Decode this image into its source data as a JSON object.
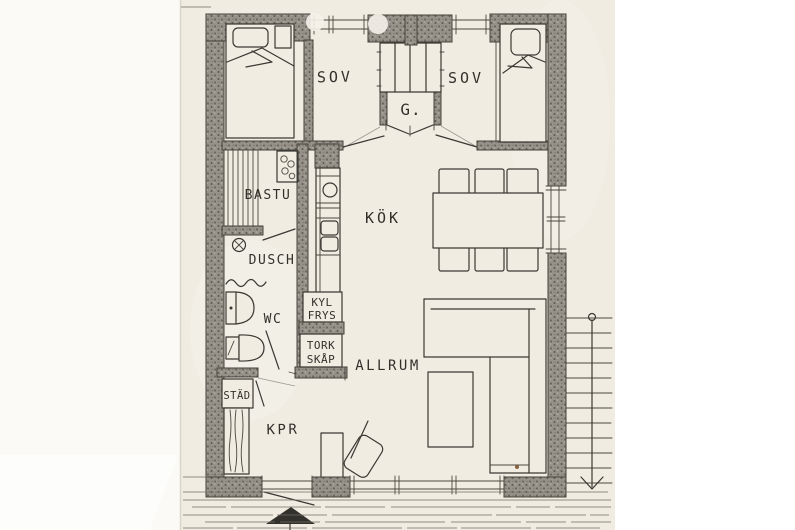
{
  "floor_plan": {
    "rooms": {
      "bedroom_left": {
        "label": "SOV"
      },
      "bedroom_right": {
        "label": "SOV"
      },
      "wardrobe": {
        "label": "G."
      },
      "sauna": {
        "label": "BASTU"
      },
      "shower": {
        "label": "DUSCH"
      },
      "toilet": {
        "label": "WC"
      },
      "kitchen": {
        "label": "KÖK"
      },
      "living_room": {
        "label": "ALLRUM"
      },
      "hall": {
        "label": "KPR"
      },
      "cleaning_closet": {
        "label": "STÄD"
      },
      "fridge_freezer": {
        "line1": "KYL",
        "line2": "FRYS"
      },
      "drying_cabinet": {
        "line1": "TORK",
        "line2": "SKÅP"
      }
    },
    "colors": {
      "paper": "#f0ece2",
      "ink": "#3b3833",
      "wall": "#96928a"
    }
  }
}
